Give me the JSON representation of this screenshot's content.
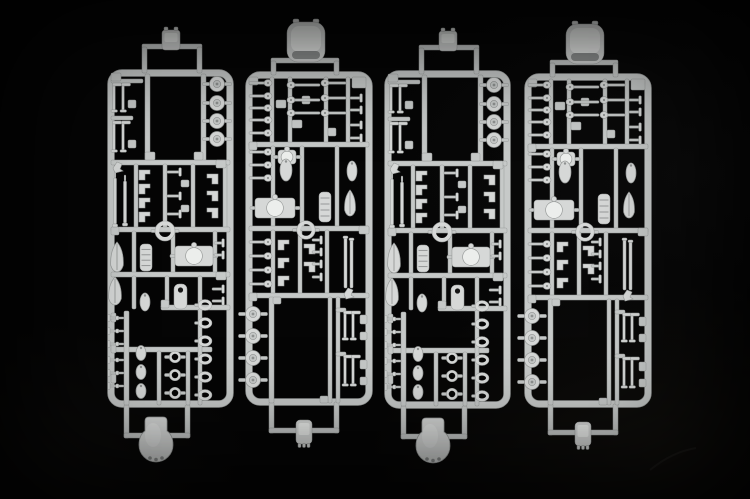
{
  "scene": {
    "description": "Photograph of four light-gray injection-molded plastic model kit sprues with small warship parts (turrets, ship's boats, discs, pins) laid vertically side by side on a black background",
    "width": 750,
    "height": 499,
    "background_color": "#050505",
    "colors": {
      "runner": "#c6c9c8",
      "part": "#d6d8d7",
      "highlight": "#eceeec",
      "shadow": "#8f9291",
      "edge": "#999c9b",
      "hole": "#161616"
    },
    "sprue_count": 4
  },
  "sprues": [
    {
      "name": "sprue-1",
      "template": "A",
      "x": 101,
      "y": 0
    },
    {
      "name": "sprue-2",
      "template": "B",
      "x": 240,
      "y": 0
    },
    {
      "name": "sprue-3",
      "template": "A",
      "x": 378,
      "y": 1
    },
    {
      "name": "sprue-4",
      "template": "B",
      "x": 519,
      "y": 2
    }
  ],
  "templates": {
    "A": {
      "frame": {
        "x": 7,
        "y": 70,
        "w": 125,
        "h": 337,
        "bar": 6,
        "r": 11
      },
      "bars": [
        [
          41,
          44,
          60,
          5
        ],
        [
          41,
          47,
          5,
          26
        ],
        [
          96,
          47,
          5,
          26
        ],
        [
          23,
          405,
          5,
          33
        ],
        [
          84,
          405,
          5,
          33
        ],
        [
          23,
          433,
          66,
          5
        ],
        [
          44,
          74,
          5,
          89
        ],
        [
          100,
          74,
          5,
          89
        ],
        [
          10,
          79,
          32,
          4
        ],
        [
          10,
          116,
          22,
          4
        ],
        [
          10,
          160,
          119,
          5
        ],
        [
          33,
          164,
          4,
          66
        ],
        [
          62,
          164,
          4,
          66
        ],
        [
          90,
          164,
          4,
          66
        ],
        [
          122,
          164,
          4,
          66
        ],
        [
          10,
          227,
          119,
          5
        ],
        [
          31,
          231,
          4,
          44
        ],
        [
          70,
          231,
          4,
          44
        ],
        [
          112,
          231,
          4,
          44
        ],
        [
          10,
          272,
          119,
          5
        ],
        [
          31,
          276,
          4,
          33
        ],
        [
          64,
          276,
          4,
          33
        ],
        [
          97,
          276,
          4,
          36
        ],
        [
          60,
          305,
          69,
          5
        ],
        [
          10,
          347,
          101,
          5
        ],
        [
          23,
          311,
          5,
          94
        ],
        [
          56,
          351,
          4,
          54
        ],
        [
          85,
          351,
          4,
          54
        ],
        [
          97,
          309,
          4,
          96
        ],
        [
          27,
          100,
          8,
          8
        ],
        [
          27,
          140,
          8,
          8
        ],
        [
          44,
          152,
          10,
          8
        ],
        [
          93,
          152,
          9,
          8
        ],
        [
          80,
          180,
          8,
          7
        ],
        [
          80,
          205,
          8,
          7
        ],
        [
          10,
          313,
          5,
          9
        ],
        [
          10,
          344,
          5,
          9
        ],
        [
          10,
          374,
          5,
          9
        ],
        [
          10,
          73,
          10,
          8
        ],
        [
          115,
          160,
          10,
          8
        ],
        [
          10,
          227,
          8,
          8
        ],
        [
          115,
          272,
          10,
          8
        ],
        [
          60,
          300,
          8,
          8
        ]
      ],
      "parts": [
        [
          "tabA",
          70,
          40
        ],
        [
          "stem",
          13,
          84,
          28
        ],
        [
          "stem",
          22,
          84,
          28
        ],
        [
          "stem",
          13,
          122,
          30
        ],
        [
          "stem",
          22,
          122,
          30
        ],
        [
          "disc",
          116,
          84,
          7.5
        ],
        [
          "disc",
          116,
          103,
          7.5
        ],
        [
          "disc",
          116,
          121,
          7.5
        ],
        [
          "disc",
          116,
          139,
          7.5
        ],
        [
          "anglep",
          12,
          162
        ],
        [
          "barrel",
          14,
          178,
          46
        ],
        [
          "barrel",
          24,
          181,
          42
        ],
        [
          "stepbr",
          38,
          170,
          1
        ],
        [
          "stepbr",
          38,
          184,
          1
        ],
        [
          "stepbr",
          38,
          198,
          1
        ],
        [
          "stepbr",
          38,
          212,
          1
        ],
        [
          "bitt",
          66,
          172,
          14
        ],
        [
          "bitt",
          66,
          196,
          14
        ],
        [
          "bitt",
          66,
          214,
          14
        ],
        [
          "stepbr",
          106,
          174,
          -1
        ],
        [
          "stepbr",
          106,
          191,
          -1
        ],
        [
          "stepbr",
          106,
          208,
          -1
        ],
        [
          "ring",
          64,
          231,
          8,
          4
        ],
        [
          "boat",
          16,
          257,
          7,
          15
        ],
        [
          "ribboat",
          39,
          244,
          12,
          27
        ],
        [
          "turret",
          74,
          246,
          38,
          20
        ],
        [
          "boat",
          14,
          291,
          7,
          14
        ],
        [
          "egg",
          44,
          302,
          5,
          9
        ],
        [
          "holepart",
          73,
          284,
          13,
          25
        ],
        [
          "bitt",
          113,
          243,
          10
        ],
        [
          "bitt",
          113,
          255,
          10
        ],
        [
          "bitt",
          111,
          289,
          12
        ],
        [
          "bitt",
          111,
          301,
          12
        ],
        [
          "tpin",
          8,
          318,
          15
        ],
        [
          "tpin",
          8,
          331,
          15
        ],
        [
          "tpin",
          8,
          344,
          15
        ],
        [
          "tpin",
          8,
          360,
          15
        ],
        [
          "tpin",
          8,
          373,
          15
        ],
        [
          "tpin",
          8,
          386,
          15
        ],
        [
          "egg",
          40,
          353,
          5,
          7.5
        ],
        [
          "egg",
          40,
          372,
          5,
          7.5
        ],
        [
          "egg",
          40,
          391,
          5,
          7.5
        ],
        [
          "ring",
          74,
          357,
          4.5,
          2.5
        ],
        [
          "ring",
          74,
          375,
          4.5,
          2.5
        ],
        [
          "ring",
          74,
          393,
          4.5,
          2.5
        ],
        [
          "oring",
          104,
          305,
          5.5,
          4
        ],
        [
          "oring",
          104,
          323,
          5.5,
          4
        ],
        [
          "oring",
          104,
          341,
          5.5,
          4
        ],
        [
          "oring",
          104,
          359,
          5.5,
          4
        ],
        [
          "oring",
          104,
          377,
          5.5,
          4
        ],
        [
          "oring",
          104,
          395,
          5.5,
          4
        ],
        [
          "dome",
          55,
          441
        ]
      ]
    },
    "B": {
      "frame": {
        "x": 6,
        "y": 72,
        "w": 126,
        "h": 333,
        "bar": 6,
        "r": 11
      },
      "bars": [
        [
          31,
          58,
          68,
          5
        ],
        [
          31,
          61,
          5,
          14
        ],
        [
          94,
          61,
          5,
          14
        ],
        [
          29,
          402,
          5,
          31
        ],
        [
          94,
          402,
          5,
          31
        ],
        [
          29,
          428,
          70,
          5
        ],
        [
          30,
          77,
          4,
          66
        ],
        [
          48,
          77,
          4,
          66
        ],
        [
          84,
          77,
          4,
          66
        ],
        [
          106,
          77,
          4,
          66
        ],
        [
          9,
          142,
          120,
          5
        ],
        [
          31,
          146,
          4,
          81
        ],
        [
          60,
          146,
          4,
          81
        ],
        [
          95,
          146,
          4,
          81
        ],
        [
          9,
          226,
          120,
          5
        ],
        [
          31,
          230,
          4,
          64
        ],
        [
          58,
          230,
          4,
          64
        ],
        [
          85,
          230,
          4,
          64
        ],
        [
          9,
          293,
          120,
          5
        ],
        [
          29,
          297,
          5,
          106
        ],
        [
          88,
          297,
          4,
          106
        ],
        [
          96,
          297,
          4,
          106
        ],
        [
          96,
          308,
          10,
          4
        ],
        [
          96,
          352,
          10,
          4
        ],
        [
          112,
          77,
          14,
          11
        ],
        [
          36,
          100,
          10,
          8
        ],
        [
          62,
          96,
          8,
          8
        ],
        [
          52,
          120,
          10,
          8
        ],
        [
          88,
          128,
          8,
          8
        ],
        [
          120,
          315,
          7,
          9
        ],
        [
          120,
          332,
          7,
          8
        ],
        [
          120,
          360,
          7,
          9
        ],
        [
          120,
          377,
          7,
          8
        ],
        [
          9,
          77,
          9,
          8
        ],
        [
          9,
          142,
          8,
          8
        ],
        [
          119,
          226,
          10,
          8
        ],
        [
          9,
          293,
          8,
          8
        ],
        [
          33,
          297,
          8,
          7
        ],
        [
          80,
          396,
          8,
          7
        ]
      ],
      "parts": [
        [
          "bigdome",
          66,
          42
        ],
        [
          "pin",
          9,
          83,
          16,
          1
        ],
        [
          "pin",
          9,
          96,
          16,
          1
        ],
        [
          "pin",
          9,
          108,
          16,
          1
        ],
        [
          "pin",
          9,
          120,
          16,
          1
        ],
        [
          "pin",
          9,
          133,
          16,
          1
        ],
        [
          "pin",
          54,
          85,
          26,
          -1
        ],
        [
          "pin",
          54,
          100,
          26,
          -1
        ],
        [
          "pin",
          54,
          113,
          26,
          -1
        ],
        [
          "pin",
          88,
          83,
          18,
          -1
        ],
        [
          "pin",
          88,
          98,
          18,
          -1
        ],
        [
          "pin",
          88,
          113,
          18,
          -1
        ],
        [
          "bitt",
          110,
          98,
          12
        ],
        [
          "bitt",
          110,
          110,
          12
        ],
        [
          "bitt",
          110,
          125,
          12
        ],
        [
          "bitt",
          110,
          138,
          12
        ],
        [
          "pin",
          9,
          152,
          16,
          1
        ],
        [
          "pin",
          9,
          165,
          16,
          1
        ],
        [
          "pin",
          9,
          178,
          16,
          1
        ],
        [
          "turret",
          38,
          150,
          18,
          14
        ],
        [
          "egg",
          46,
          170,
          6,
          11
        ],
        [
          "egg",
          112,
          171,
          5,
          10
        ],
        [
          "turret",
          15,
          198,
          40,
          20
        ],
        [
          "ribboat",
          79,
          192,
          12,
          30
        ],
        [
          "boat",
          110,
          203,
          6,
          13
        ],
        [
          "ring",
          66,
          230,
          7.5,
          3.5
        ],
        [
          "pin",
          9,
          242,
          16,
          1
        ],
        [
          "pin",
          9,
          256,
          16,
          1
        ],
        [
          "pin",
          9,
          270,
          16,
          1
        ],
        [
          "pin",
          9,
          284,
          16,
          1
        ],
        [
          "stepbr",
          38,
          240,
          1
        ],
        [
          "stepbr",
          38,
          258,
          1
        ],
        [
          "stepbr",
          38,
          276,
          1
        ],
        [
          "stepbr",
          64,
          244,
          -1
        ],
        [
          "stepbr",
          64,
          262,
          -1
        ],
        [
          "bitt",
          72,
          240,
          10
        ],
        [
          "bitt",
          72,
          252,
          10
        ],
        [
          "bitt",
          72,
          264,
          10
        ],
        [
          "bitt",
          72,
          277,
          10
        ],
        [
          "strip",
          104,
          238,
          3,
          50
        ],
        [
          "strip",
          110,
          240,
          3,
          48
        ],
        [
          "anglep",
          104,
          288
        ],
        [
          "disc",
          13,
          314,
          7.5
        ],
        [
          "disc",
          13,
          336,
          7.5
        ],
        [
          "disc",
          13,
          358,
          7.5
        ],
        [
          "disc",
          13,
          380,
          7.5
        ],
        [
          "stem",
          105,
          312,
          28
        ],
        [
          "stem",
          113,
          312,
          28
        ],
        [
          "stem",
          105,
          356,
          30
        ],
        [
          "stem",
          113,
          356,
          30
        ],
        [
          "tabB",
          64,
          433
        ]
      ]
    }
  }
}
